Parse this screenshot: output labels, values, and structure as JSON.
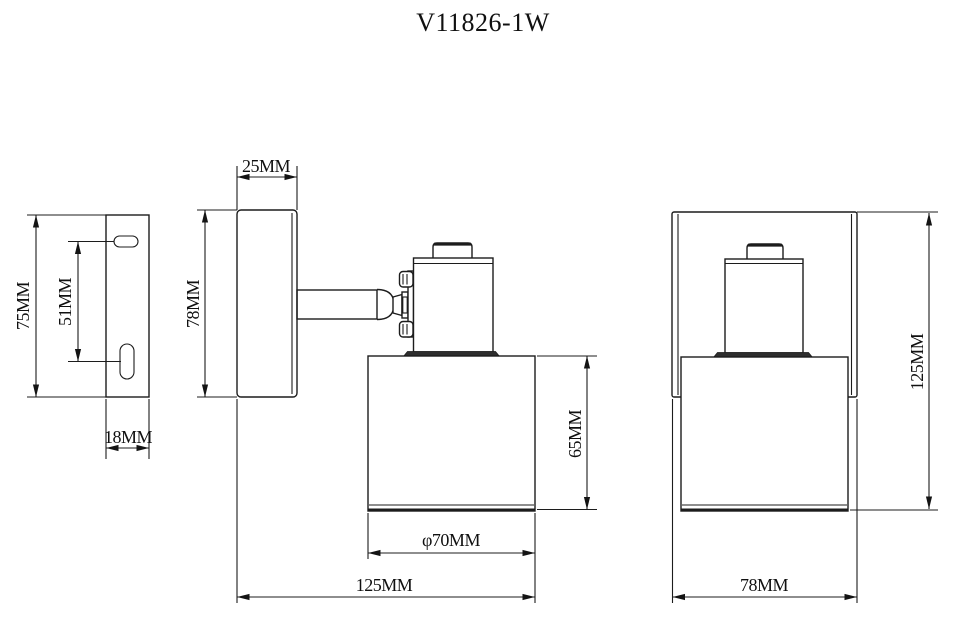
{
  "title": "V11826-1W",
  "colors": {
    "background": "#ffffff",
    "line": "#1c1c1c",
    "dark_fill": "#2e2e2e"
  },
  "left_view": {
    "height": "75MM",
    "slot_spacing": "51MM",
    "depth": "18MM"
  },
  "center_view": {
    "plate_depth": "25MM",
    "plate_height": "78MM",
    "shade_height": "65MM",
    "shade_diameter": "φ70MM",
    "overall_width": "125MM"
  },
  "right_view": {
    "overall_height": "125MM",
    "plate_width": "78MM"
  }
}
